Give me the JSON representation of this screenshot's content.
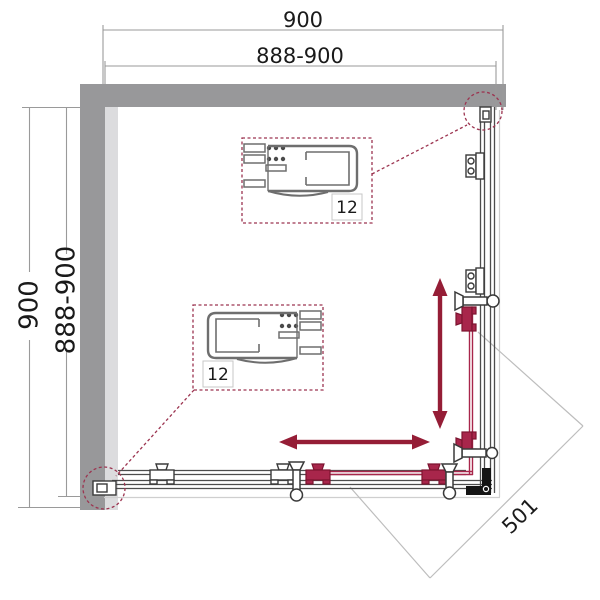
{
  "dimensions": {
    "top": {
      "overall": "900",
      "adjustable": "888-900"
    },
    "left": {
      "overall": "900",
      "adjustable": "888-900"
    },
    "diagonal_entry": "501"
  },
  "details": {
    "top_callout_label": "12",
    "bottom_callout_label": "12"
  },
  "colors": {
    "wall": "#98989a",
    "frame": "#4d4d4d",
    "sliding_door": "#a8264b",
    "arrow": "#951d36",
    "callout": "#9c3450",
    "dimension_line": "#9a9a9a",
    "tray_edge": "#cfcfcf",
    "text": "#1a1a1a"
  }
}
